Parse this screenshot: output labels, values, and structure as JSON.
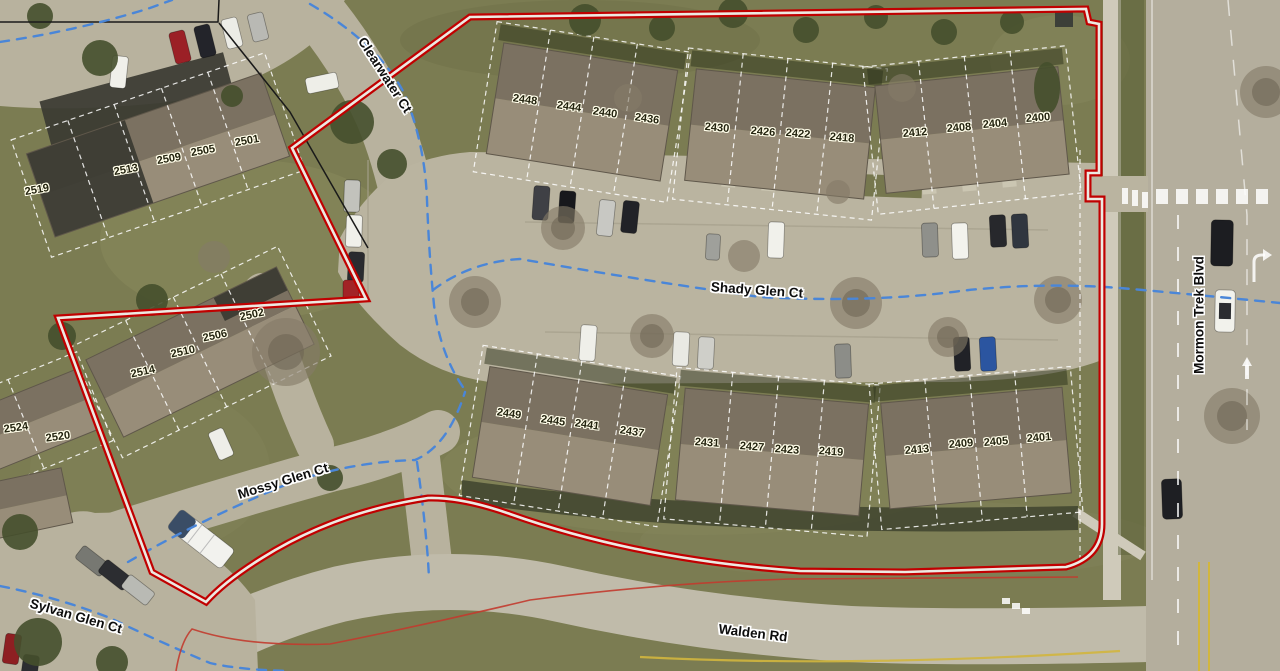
{
  "map": {
    "type_note": "aerial parcel map with outlined project boundary",
    "colors": {
      "boundary_red": "#c00000",
      "boundary_core": "#ece9e2",
      "centerline_blue": "#4a86d8",
      "parcel_line_white": "#ffffff",
      "adjacent_boundary_black": "#1a1a1a",
      "thin_red_line": "#c23b2e",
      "label_halo": "#fffde9"
    }
  },
  "parcel_labels": [
    {
      "text": "2519",
      "x": 37,
      "y": 190,
      "rot": -10
    },
    {
      "text": "2513",
      "x": 126,
      "y": 170,
      "rot": -10
    },
    {
      "text": "2509",
      "x": 169,
      "y": 159,
      "rot": -10
    },
    {
      "text": "2505",
      "x": 203,
      "y": 151,
      "rot": -10
    },
    {
      "text": "2501",
      "x": 247,
      "y": 141,
      "rot": -10
    },
    {
      "text": "2502",
      "x": 252,
      "y": 315,
      "rot": -12
    },
    {
      "text": "2506",
      "x": 215,
      "y": 336,
      "rot": -12
    },
    {
      "text": "2510",
      "x": 183,
      "y": 352,
      "rot": -12
    },
    {
      "text": "2514",
      "x": 143,
      "y": 372,
      "rot": -12
    },
    {
      "text": "2524",
      "x": 16,
      "y": 428,
      "rot": -8
    },
    {
      "text": "2520",
      "x": 58,
      "y": 437,
      "rot": -8
    },
    {
      "text": "2448",
      "x": 525,
      "y": 100,
      "rot": 8
    },
    {
      "text": "2444",
      "x": 569,
      "y": 107,
      "rot": 8
    },
    {
      "text": "2440",
      "x": 605,
      "y": 113,
      "rot": 8
    },
    {
      "text": "2436",
      "x": 647,
      "y": 119,
      "rot": 8
    },
    {
      "text": "2430",
      "x": 717,
      "y": 128,
      "rot": 5
    },
    {
      "text": "2426",
      "x": 763,
      "y": 132,
      "rot": 5
    },
    {
      "text": "2422",
      "x": 798,
      "y": 134,
      "rot": 5
    },
    {
      "text": "2418",
      "x": 842,
      "y": 138,
      "rot": 5
    },
    {
      "text": "2412",
      "x": 915,
      "y": 133,
      "rot": -5
    },
    {
      "text": "2408",
      "x": 959,
      "y": 128,
      "rot": -5
    },
    {
      "text": "2404",
      "x": 995,
      "y": 124,
      "rot": -5
    },
    {
      "text": "2400",
      "x": 1038,
      "y": 118,
      "rot": -5
    },
    {
      "text": "2449",
      "x": 509,
      "y": 414,
      "rot": 8
    },
    {
      "text": "2445",
      "x": 553,
      "y": 421,
      "rot": 8
    },
    {
      "text": "2441",
      "x": 587,
      "y": 425,
      "rot": 8
    },
    {
      "text": "2437",
      "x": 632,
      "y": 432,
      "rot": 8
    },
    {
      "text": "2431",
      "x": 707,
      "y": 443,
      "rot": 4
    },
    {
      "text": "2427",
      "x": 752,
      "y": 447,
      "rot": 4
    },
    {
      "text": "2423",
      "x": 787,
      "y": 450,
      "rot": 4
    },
    {
      "text": "2419",
      "x": 831,
      "y": 452,
      "rot": 4
    },
    {
      "text": "2413",
      "x": 917,
      "y": 450,
      "rot": -5
    },
    {
      "text": "2409",
      "x": 961,
      "y": 444,
      "rot": -5
    },
    {
      "text": "2405",
      "x": 996,
      "y": 442,
      "rot": -5
    },
    {
      "text": "2401",
      "x": 1039,
      "y": 438,
      "rot": -5
    }
  ],
  "street_labels": [
    {
      "text": "Clearwater Ct",
      "x": 385,
      "y": 75,
      "rot": 57
    },
    {
      "text": "Shady Glen Ct",
      "x": 757,
      "y": 290,
      "rot": 4
    },
    {
      "text": "Mossy Glen Ct",
      "x": 283,
      "y": 481,
      "rot": -17
    },
    {
      "text": "Sylvan Glen Ct",
      "x": 76,
      "y": 616,
      "rot": 16
    },
    {
      "text": "Walden Rd",
      "x": 753,
      "y": 633,
      "rot": 7
    },
    {
      "text": "Mormon Trek Blvd",
      "x": 1199,
      "y": 315,
      "rot": -90
    }
  ]
}
